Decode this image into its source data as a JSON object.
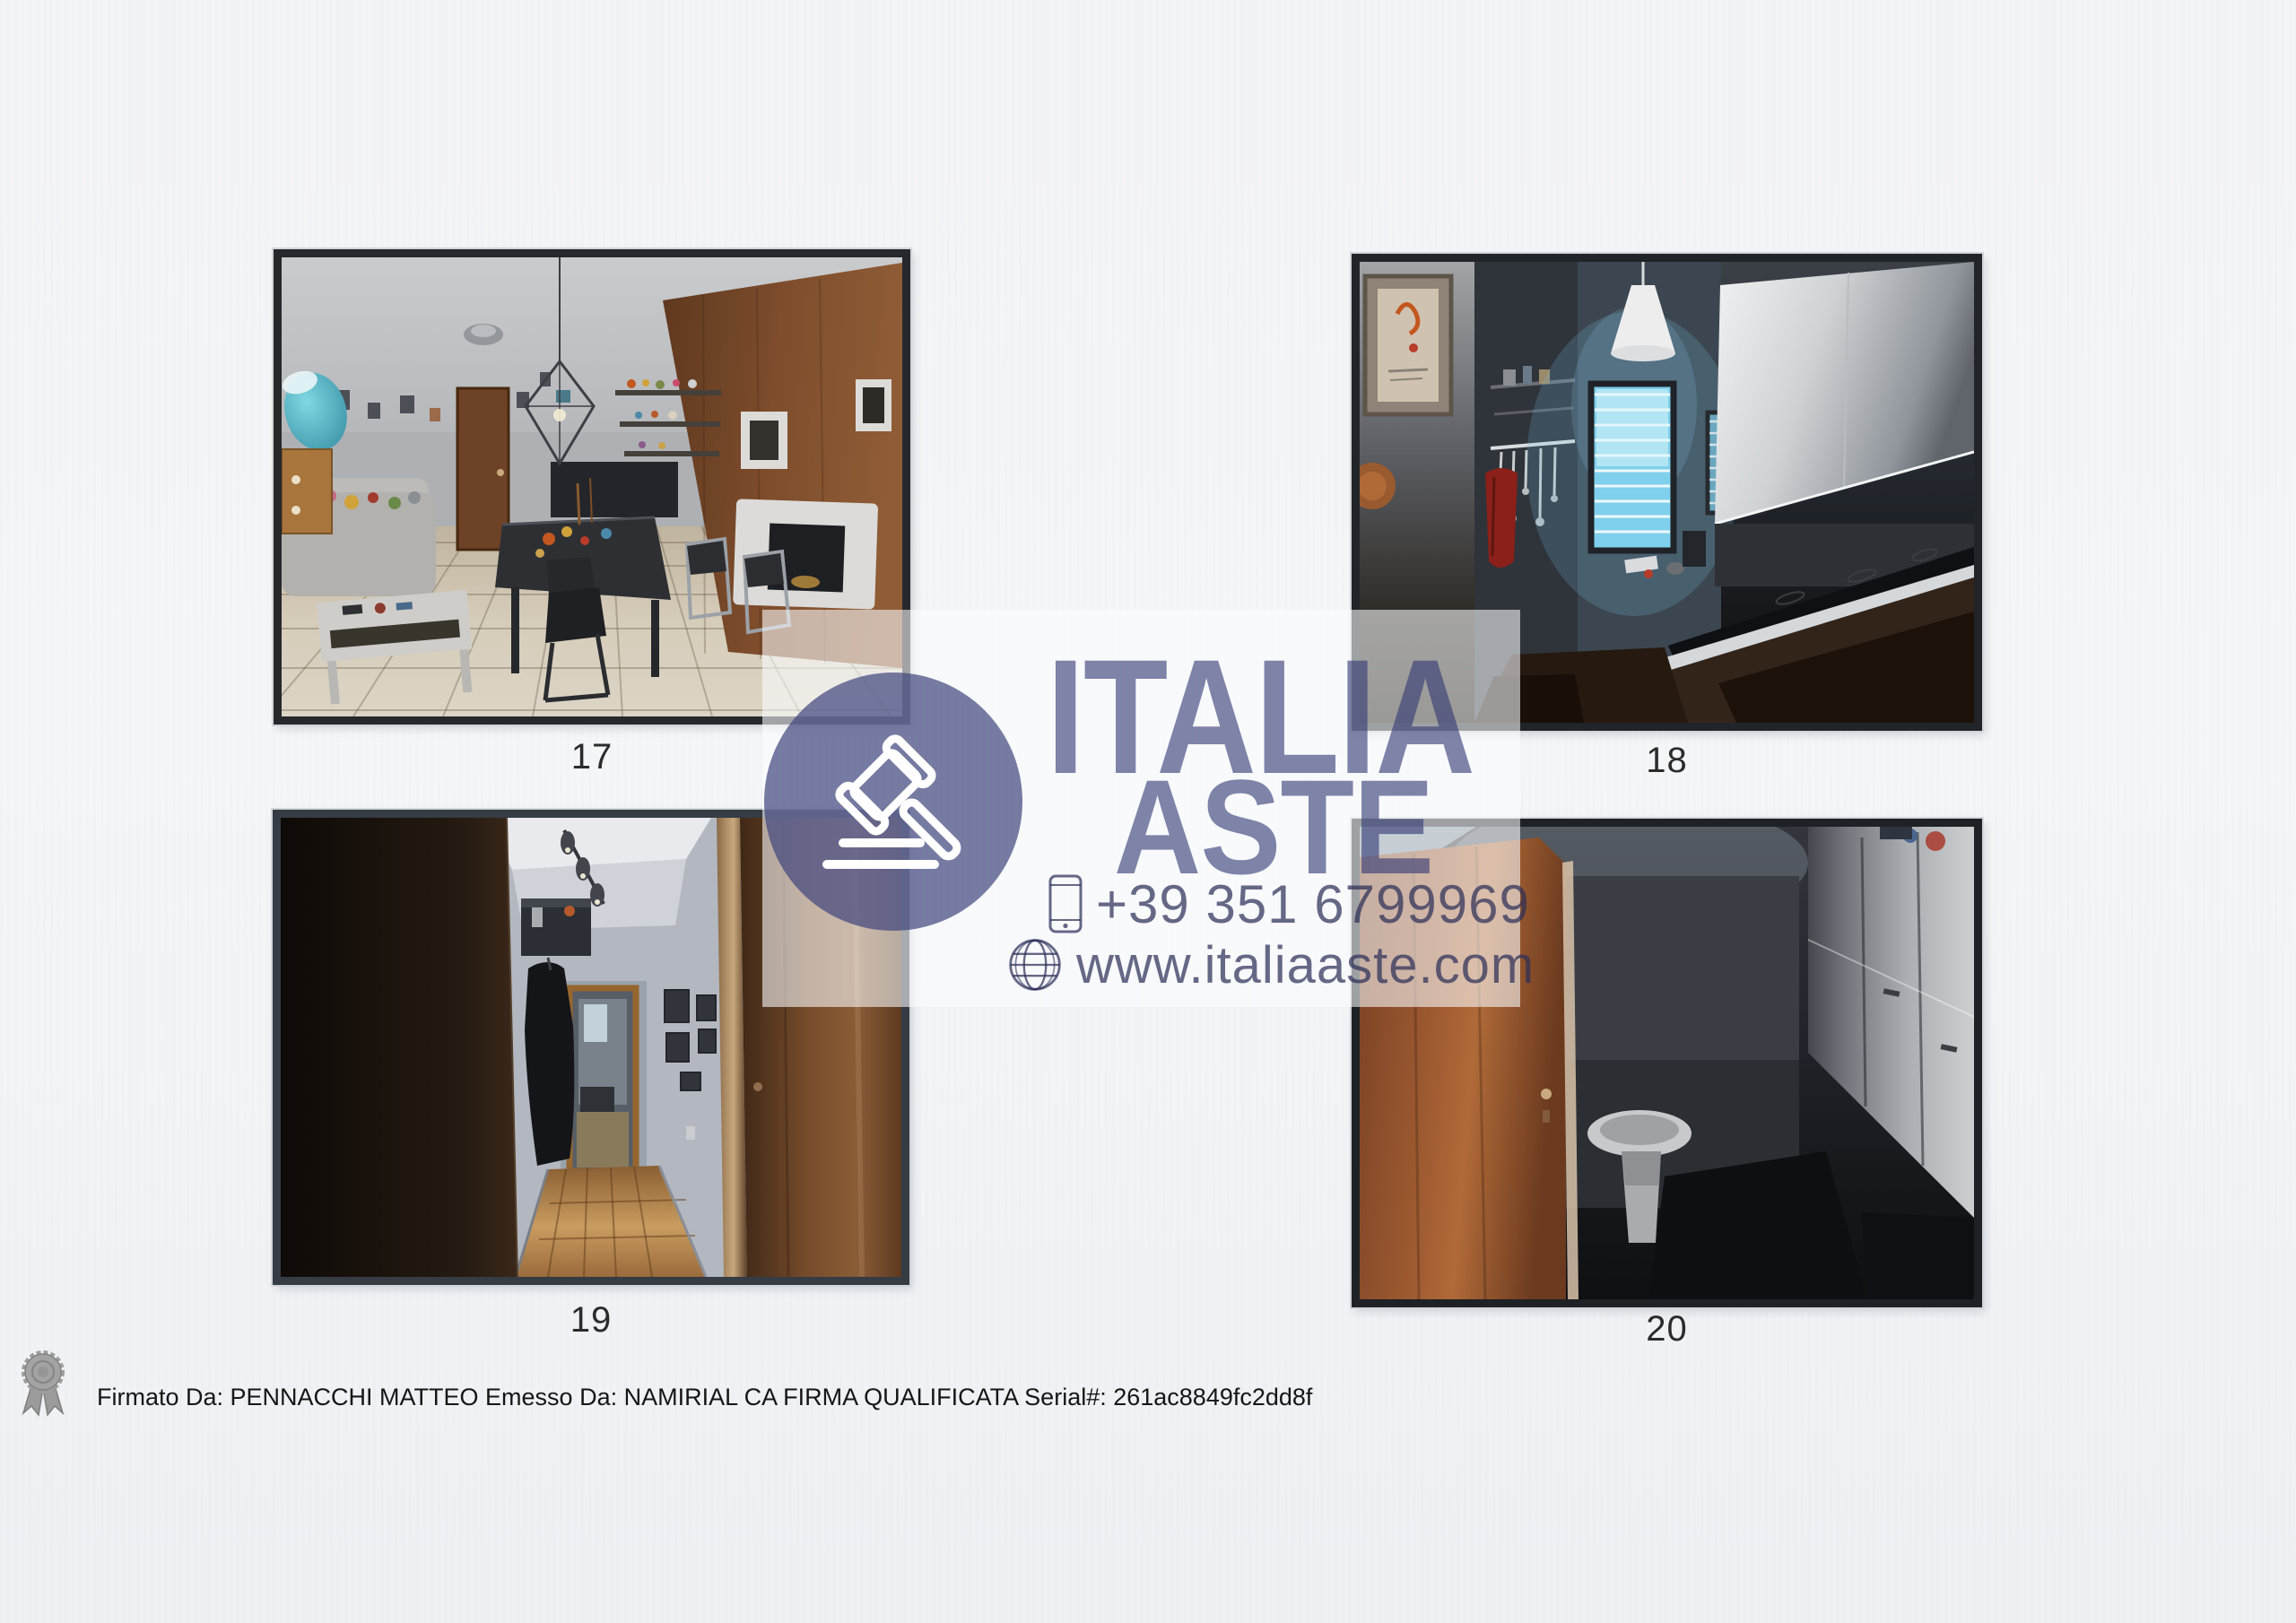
{
  "page": {
    "background_color": "#f3f4f6",
    "photo_frame_color": "#26282c",
    "caption_color": "#2b2b2b"
  },
  "photos": [
    {
      "number": "17"
    },
    {
      "number": "18"
    },
    {
      "number": "19"
    },
    {
      "number": "20"
    }
  ],
  "watermark": {
    "brand_line1": "ITALIA",
    "brand_line2": "ASTE",
    "phone": "+39 351 6799969",
    "website": "www.italiaaste.com",
    "accent_color": "#3a3f77",
    "panel_color": "rgba(252,253,255,0.58)",
    "icons": {
      "badge": "gavel-icon",
      "phone_row": "phone-icon",
      "website_row": "globe-icon"
    }
  },
  "signature": {
    "icon": "ribbon-seal-icon",
    "text": "Firmato Da: PENNACCHI MATTEO Emesso Da: NAMIRIAL CA FIRMA QUALIFICATA Serial#: 261ac8849fc2dd8f"
  }
}
